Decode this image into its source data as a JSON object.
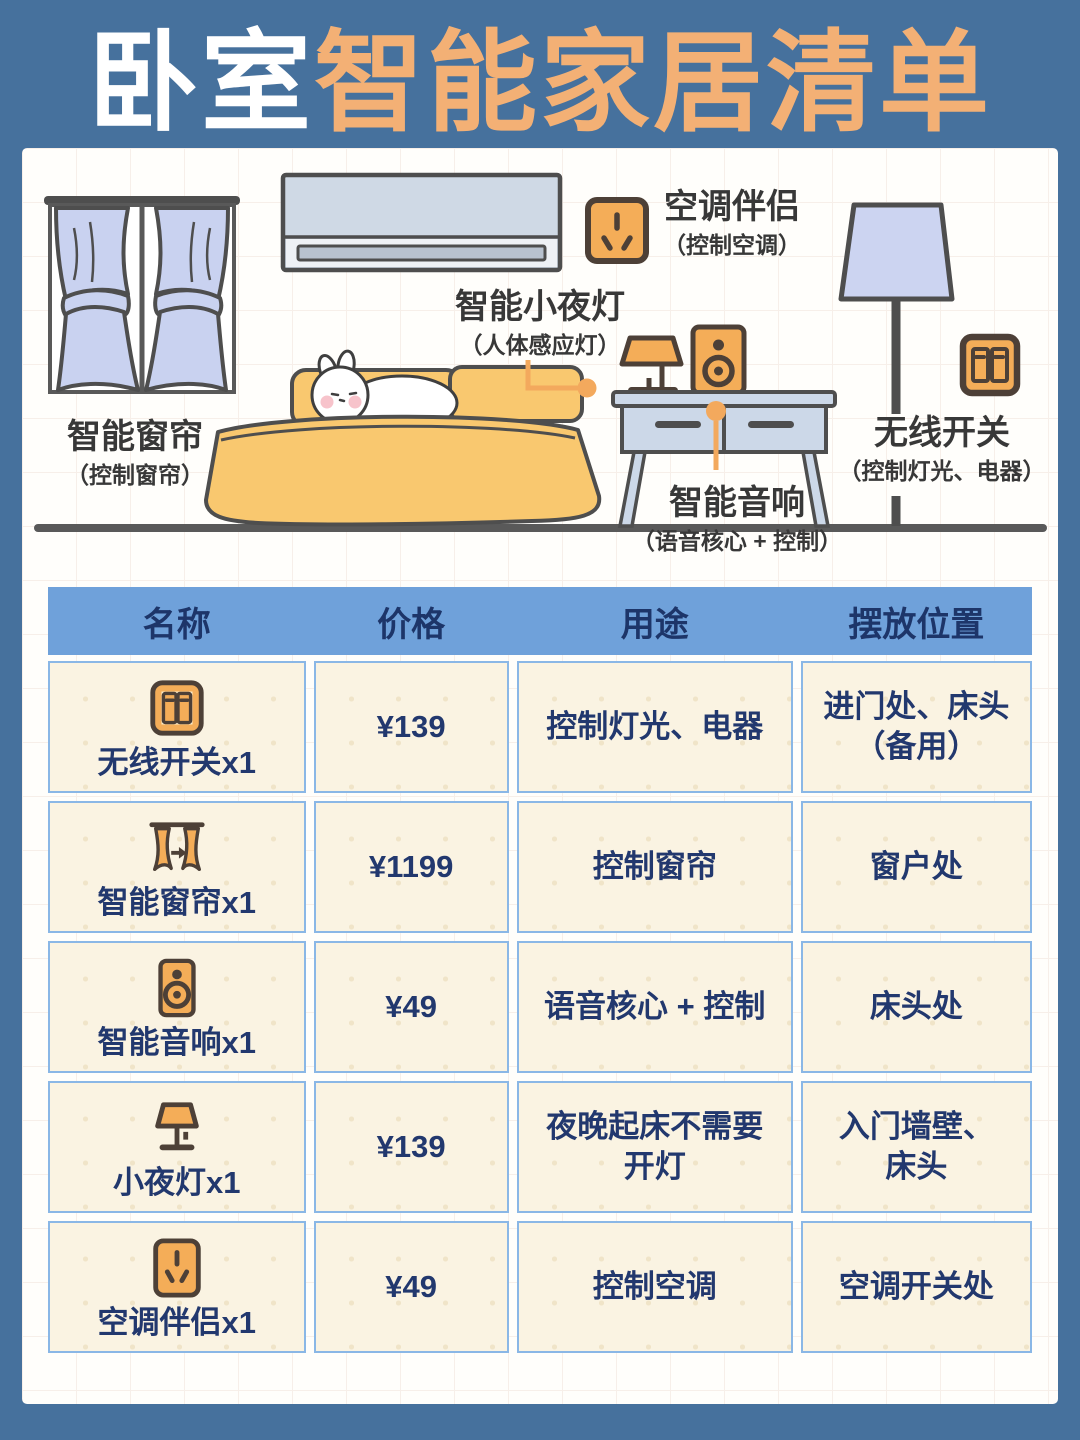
{
  "title": {
    "part1": "卧室",
    "part2": "智能家居清单"
  },
  "colors": {
    "frame_blue": "#46719d",
    "title_orange": "#f3b075",
    "table_header_blue": "#6fa1da",
    "table_text_navy": "#22386e",
    "cell_cream": "#faf3e2",
    "cell_border_blue": "#8ab7e6",
    "icon_orange": "#f4ad58",
    "icon_outline_brown": "#4d4037",
    "connector_orange": "#f3a95d",
    "furniture_blue": "#ccd8e8",
    "curtain_periwinkle": "#c9d2f0",
    "bed_yellow": "#f9c86f"
  },
  "diagram": {
    "labels": {
      "curtain": {
        "main": "智能窗帘",
        "sub": "（控制窗帘）"
      },
      "ac": {
        "main": "空调伴侣",
        "sub": "（控制空调）"
      },
      "nightlight": {
        "main": "智能小夜灯",
        "sub": "（人体感应灯）"
      },
      "speaker": {
        "main": "智能音响",
        "sub": "（语音核心 + 控制）"
      },
      "wswitch": {
        "main": "无线开关",
        "sub": "（控制灯光、电器）"
      }
    },
    "icons": [
      "socket-icon",
      "wall-switch-icon",
      "floor-lamp",
      "night-lamp",
      "speaker",
      "bed",
      "air-conditioner",
      "window-curtains"
    ]
  },
  "table": {
    "headers": [
      "名称",
      "价格",
      "用途",
      "摆放位置"
    ],
    "rows": [
      {
        "icon": "wireless-switch",
        "name": "无线开关x1",
        "price": "¥139",
        "use": "控制灯光、电器",
        "place": "进门处、床头\n（备用）"
      },
      {
        "icon": "curtain",
        "name": "智能窗帘x1",
        "price": "¥1199",
        "use": "控制窗帘",
        "place": "窗户处"
      },
      {
        "icon": "speaker",
        "name": "智能音响x1",
        "price": "¥49",
        "use": "语音核心 + 控制",
        "place": "床头处"
      },
      {
        "icon": "night-light",
        "name": "小夜灯x1",
        "price": "¥139",
        "use": "夜晚起床不需要\n开灯",
        "place": "入门墙壁、\n床头"
      },
      {
        "icon": "ac-companion",
        "name": "空调伴侣x1",
        "price": "¥49",
        "use": "控制空调",
        "place": "空调开关处"
      }
    ]
  }
}
